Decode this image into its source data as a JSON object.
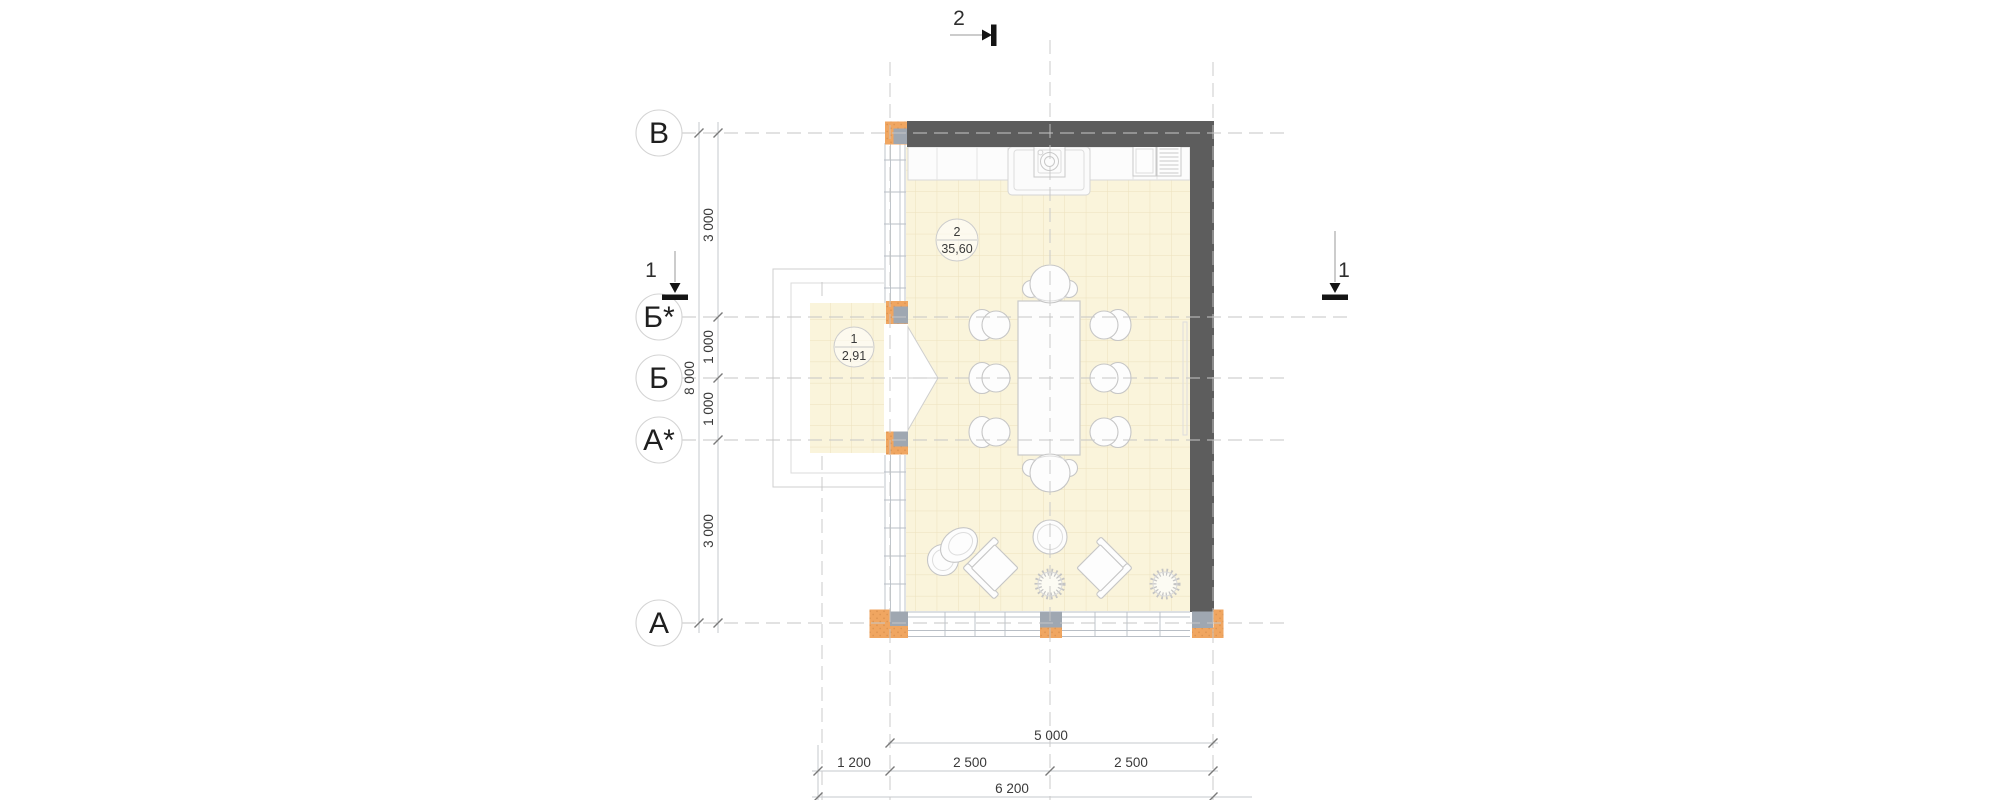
{
  "plan": {
    "axis_labels": [
      "В",
      "Б*",
      "Б",
      "А*",
      "А"
    ],
    "sections": {
      "top": "2",
      "left": "1",
      "right": "1"
    },
    "dims_left": {
      "segments": [
        "3 000",
        "1 000",
        "1 000",
        "3 000"
      ],
      "total": "8 000"
    },
    "dims_bottom": {
      "overall_top": "5 000",
      "segments": [
        "1 200",
        "2 500",
        "2 500"
      ],
      "total": "6 200"
    },
    "rooms": [
      {
        "number": "2",
        "area": "35,60"
      },
      {
        "number": "1",
        "area": "2,91"
      }
    ],
    "colors": {
      "wall": "#5d5d5d",
      "floor": "#faf4db",
      "tile_line": "#ece1bd",
      "column_orange": "#f0a661",
      "column_gray": "#9fa7b1"
    }
  }
}
